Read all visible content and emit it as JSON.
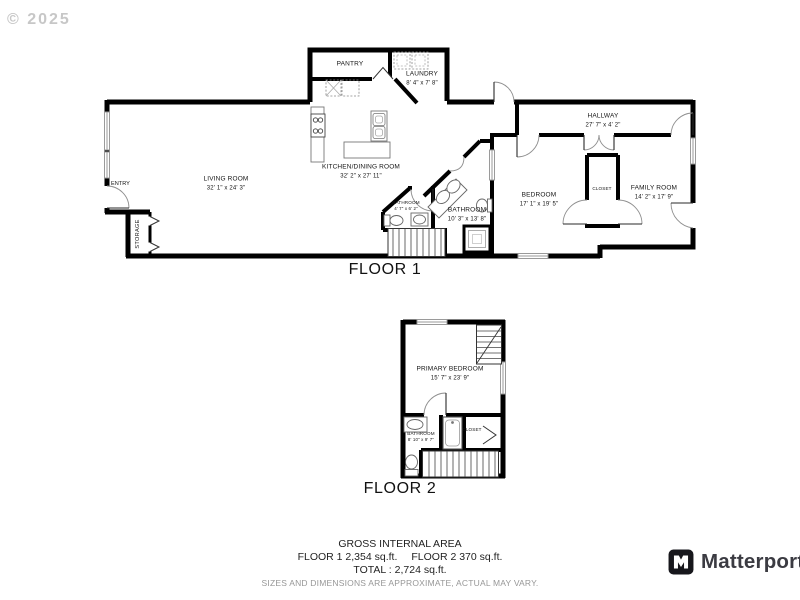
{
  "watermark": "© 2025",
  "floor1": {
    "label": "FLOOR 1",
    "rooms": {
      "pantry": {
        "name": "PANTRY"
      },
      "laundry": {
        "name": "LAUNDRY",
        "dims": "8' 4\" x 7' 8\""
      },
      "hallway": {
        "name": "HALLWAY",
        "dims": "27' 7\" x 4' 2\""
      },
      "living": {
        "name": "LIVING ROOM",
        "dims": "32' 1\" x 24' 3\""
      },
      "kitchen": {
        "name": "KITCHEN/DINING ROOM",
        "dims": "32' 2\" x 27' 11\""
      },
      "entry": {
        "name": "ENTRY"
      },
      "storage": {
        "name": "STORAGE"
      },
      "bath_small": {
        "name": "BATHROOM",
        "dims": "4' 7\" x 6' 2\""
      },
      "bath_main": {
        "name": "BATHROOM",
        "dims": "10' 3\" x 13' 8\""
      },
      "bedroom": {
        "name": "BEDROOM",
        "dims": "17' 1\" x 19' 5\""
      },
      "closet": {
        "name": "CLOSET"
      },
      "family": {
        "name": "FAMILY ROOM",
        "dims": "14' 2\" x 17' 9\""
      }
    }
  },
  "floor2": {
    "label": "FLOOR 2",
    "rooms": {
      "primary": {
        "name": "PRIMARY BEDROOM",
        "dims": "15' 7\" x 23' 9\""
      },
      "bathroom": {
        "name": "BATHROOM",
        "dims": "8' 10\" x 9' 7\""
      },
      "closet": {
        "name": "CLOSET"
      }
    }
  },
  "footer": {
    "title": "GROSS INTERNAL AREA",
    "floor1_area": "FLOOR 1 2,354 sq.ft.",
    "floor2_area": "FLOOR 2 370 sq.ft.",
    "total": "TOTAL :  2,724 sq.ft.",
    "disclaimer": "SIZES AND DIMENSIONS ARE APPROXIMATE, ACTUAL MAY VARY."
  },
  "brand": {
    "name": "Matterport",
    "icon": "matterport-logo"
  },
  "colors": {
    "wall": "#000000",
    "window": "#9a9a9a",
    "door_arc": "#8f8f8f",
    "fixture": "#666666",
    "watermark": "#c7c7c7",
    "brand_text": "#3b3b42",
    "muted_text": "#979797"
  }
}
